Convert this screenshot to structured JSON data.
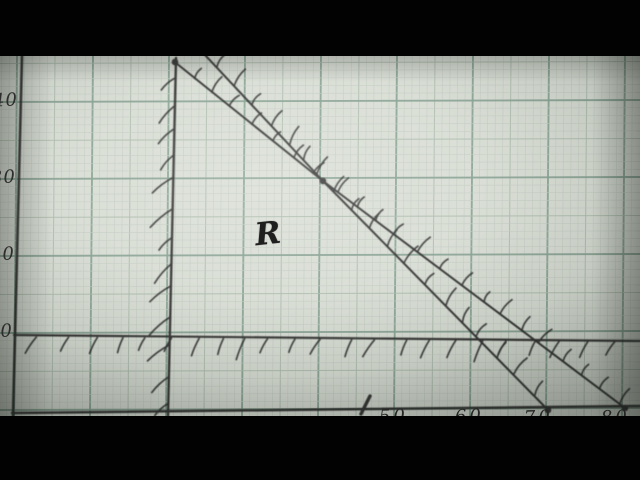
{
  "frame": {
    "kind": "photo of hand-drawn graph on green graph paper, letterboxed video frame",
    "letterbox_color": "#020202",
    "paper_color": "#d8ddd4"
  },
  "chart_data": {
    "type": "line",
    "title": "",
    "xlabel": "",
    "ylabel": "",
    "description": "Hand-drawn linear-programming graph: feasible region labelled R bounded by four pen constraint lines, each hatched on its excluded side",
    "x_ticks": [
      "50",
      "60",
      "70",
      "80"
    ],
    "x_tick_values": [
      50,
      60,
      70,
      80
    ],
    "y_ticks": [
      "40",
      "30",
      "20",
      "10"
    ],
    "y_tick_values": [
      40,
      30,
      20,
      10
    ],
    "region_label": "R",
    "axis_ranges": {
      "x": [
        0,
        82
      ],
      "y": [
        0,
        46
      ]
    },
    "grid": "on",
    "series": [
      {
        "name": "vertical boundary x = 20",
        "points": [
          [
            20,
            46
          ],
          [
            20,
            0
          ]
        ],
        "hatch_side": "left"
      },
      {
        "name": "horizontal boundary y = 10",
        "points": [
          [
            0,
            10
          ],
          [
            82,
            10
          ]
        ],
        "hatch_side": "below"
      },
      {
        "name": "boundary through (40,30) and (70,0)  (x + y = 70)",
        "points": [
          [
            24,
            46
          ],
          [
            40,
            30
          ],
          [
            70,
            0
          ]
        ],
        "hatch_side": "upper-right"
      },
      {
        "name": "boundary through (20,45), (40,30), (80,0)  (3x + 4y = 240)",
        "points": [
          [
            20,
            45
          ],
          [
            40,
            30
          ],
          [
            80,
            0
          ]
        ],
        "hatch_side": "upper-right"
      }
    ],
    "marked_points": [
      [
        20,
        45
      ],
      [
        40,
        30
      ],
      [
        70,
        0
      ],
      [
        80,
        0
      ]
    ]
  },
  "render": {
    "paper": {
      "x": 0,
      "y": 56,
      "w": 640,
      "h": 360,
      "color": "#d8ddd4"
    },
    "grid": {
      "x0": 17,
      "cw": 7.6,
      "y0": 102,
      "ch": 7.7,
      "fine": "#c2cbc1",
      "mid": "#aab9ab",
      "heavy": "#86a091"
    },
    "pen": {
      "color": "#292929"
    },
    "strokes": [
      {
        "name": "y-axis",
        "pts": [
          [
            22,
            56
          ],
          [
            13,
            416
          ]
        ],
        "w": 2.6
      },
      {
        "name": "x-axis",
        "pts": [
          [
            12,
            413
          ],
          [
            640,
            406
          ]
        ],
        "w": 2.5
      },
      {
        "name": "line-x20",
        "pts": [
          [
            176,
            58
          ],
          [
            168,
            416
          ]
        ],
        "w": 2.4
      },
      {
        "name": "line-y10",
        "pts": [
          [
            14,
            335
          ],
          [
            640,
            341
          ]
        ],
        "w": 2.2
      },
      {
        "name": "line-xy70",
        "pts": [
          [
            205,
            55
          ],
          [
            323,
            181
          ],
          [
            548,
            410
          ]
        ],
        "w": 2.0
      },
      {
        "name": "line-3x4y240",
        "pts": [
          [
            176,
            63
          ],
          [
            323,
            181
          ],
          [
            625,
            408
          ]
        ],
        "w": 2.0
      },
      {
        "name": "stray-tick",
        "pts": [
          [
            361,
            414
          ],
          [
            370,
            396
          ]
        ],
        "w": 3.4
      }
    ],
    "hatches": [
      {
        "pts": [
          [
            175,
            64
          ],
          [
            168,
            412
          ]
        ],
        "angle": 137,
        "len": 22,
        "spacing": 26,
        "bend": 2
      },
      {
        "pts": [
          [
            22,
            337
          ],
          [
            638,
            342
          ]
        ],
        "angle": 117,
        "len": 18,
        "spacing": 26,
        "bend": 1
      },
      {
        "pts": [
          [
            208,
            57
          ],
          [
            323,
            181
          ],
          [
            548,
            408
          ]
        ],
        "angle": -58,
        "len": 17,
        "spacing": 24,
        "bend": -2.6
      },
      {
        "pts": [
          [
            184,
            70
          ],
          [
            323,
            181
          ],
          [
            623,
            406
          ]
        ],
        "angle": -52,
        "len": 15,
        "spacing": 25,
        "bend": -2.4
      }
    ],
    "dots": [
      [
        175,
        62
      ],
      [
        323,
        181
      ],
      [
        548,
        410
      ],
      [
        625,
        408
      ]
    ],
    "dot_r": 3.3
  }
}
